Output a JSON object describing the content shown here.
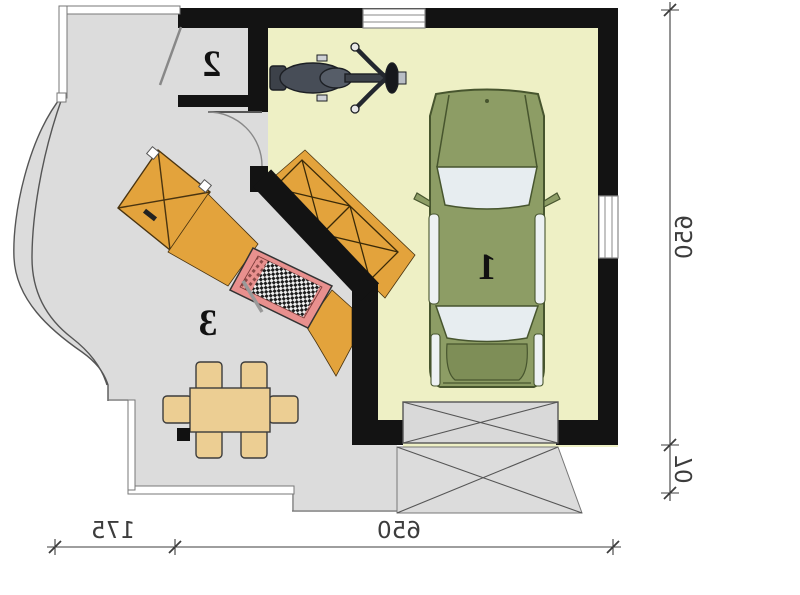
{
  "plan": {
    "type": "floor-plan",
    "mirrored": true,
    "rooms": [
      {
        "number": "1",
        "contents": [
          "car",
          "motorcycle",
          "wall-shelf"
        ]
      },
      {
        "number": "2",
        "contents": []
      },
      {
        "number": "3",
        "contents": [
          "dining-table",
          "six-chairs",
          "workbench",
          "wardrobe-cabinet"
        ]
      }
    ],
    "dimensions": {
      "right": [
        {
          "value": "650"
        },
        {
          "value": "70"
        }
      ],
      "bottom": [
        {
          "value": "175"
        },
        {
          "value": "650"
        }
      ]
    },
    "colors": {
      "garage_floor": "#eef0c5",
      "room_floor": "#dcdcdc",
      "wall": "#131313",
      "cabinet_orange": "#e3a33c",
      "workbench_pink": "#e8908e",
      "car_body": "#8d9d65",
      "glass": "#e7edf0",
      "furniture_tan": "#ecce93",
      "motorcycle_gray": "#474d57",
      "dimension_text": "#3c3c3c"
    }
  }
}
